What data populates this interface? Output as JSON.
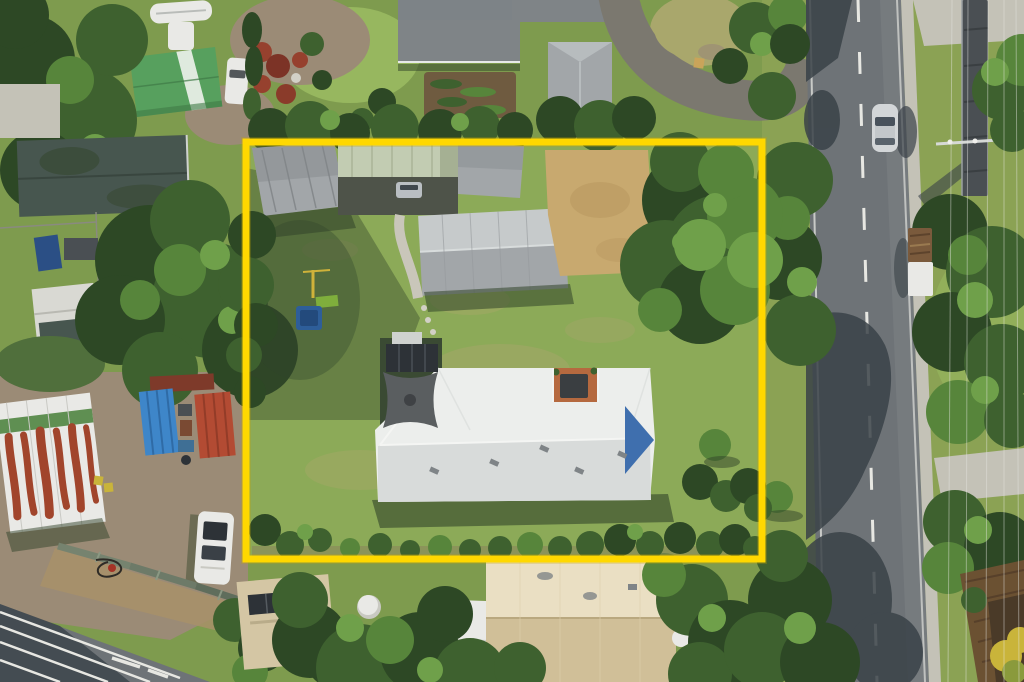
{
  "meta": {
    "type": "aerial-drone-photo",
    "description": "Top-down aerial photograph of a suburban residential lot outlined with a yellow property boundary, bordered by a vertical two-lane road on the right, neighbouring houses, sheds and trees around it.",
    "width_px": 1024,
    "height_px": 682
  },
  "scene": {
    "property_boundary": {
      "shape": "rectangle",
      "color": "#ffd800",
      "x": 246,
      "y": 142,
      "width": 516,
      "height": 417,
      "stroke_px": 7
    },
    "property": {
      "features": [
        "large lawn with dry patches",
        "main house with white hip roof and long ridge",
        "dark shade-sail pergola with solar panel at house rear corner",
        "terracotta courtyard notch with dark furniture",
        "blue tarp triangle on right roof end",
        "gray shed at top-left corner",
        "pale-green roofed carport with parked car",
        "large gray garage roof",
        "sandy dirt driveway area",
        "large tree over right boundary",
        "blue trampoline with green slide and yellow play pole",
        "garden shrubs along bottom boundary"
      ]
    },
    "road": {
      "orientation": "vertical",
      "position": "right",
      "surface": "asphalt",
      "markings": [
        "white dashed centerline",
        "white edge lines"
      ],
      "kerb": "concrete strip",
      "tree_shadows": true
    },
    "vehicles": [
      {
        "type": "car",
        "color": "silver",
        "location": "driving on road",
        "x": 884,
        "y": 128
      },
      {
        "type": "truck",
        "color": "white with brown load",
        "location": "parked on right verge",
        "x": 920,
        "y": 262
      },
      {
        "type": "caravan",
        "color": "white with solar panels",
        "location": "bottom-left yard",
        "x": 214,
        "y": 548
      },
      {
        "type": "car",
        "color": "white",
        "location": "top-left driveway",
        "x": 237,
        "y": 80
      },
      {
        "type": "boat-trailer",
        "color": "white",
        "location": "top-left",
        "x": 180,
        "y": 12
      }
    ],
    "surroundings": [
      "green shed with white stripe (top-left)",
      "dark slate roofed house (left)",
      "round blue kiddie pool and blue tarp (left yard)",
      "workshop shed with rust-streaked white roof and green band (bottom-left)",
      "bright blue shed and red shipping container (bottom-left)",
      "diagonal timber walkway over dirt (bottom-left)",
      "diagonal road with white lane lines (bottom-left corner)",
      "beige house with solar panels (bottom-center)",
      "round white water tank (bottom-center)",
      "white roofed house and large cream roof (bottom-center)",
      "curved asphalt driveway loop around dry grass circle (top-center-right)",
      "gray hip-roof houses and vegetable garden (top-center)",
      "dark elevated linear structure and power pole (top-right)",
      "power lines running along right side",
      "brown timber fenced yard with yellow flowering bush (bottom-right corner)"
    ]
  },
  "colors": {
    "grassBase": "#7e9b4e",
    "lawnInside": "#8caa58",
    "grassVerge": "#8ba254",
    "grassBright": "#97b75f",
    "dryGrass": "#a9a76c",
    "lawnShadow": "#506f3c",
    "treeDark": "#2d4825",
    "treeMid": "#3e612f",
    "treeLight": "#57853b",
    "treeHi": "#6fa04a",
    "shadow": "#32442a",
    "asphalt": "#6e7377",
    "asphaltLight": "#7b8084",
    "roadShadow": "#3a4248",
    "roadLine": "#e7e7e2",
    "concrete": "#c4c2b7",
    "concreteBright": "#d2d0c6",
    "gravel": "#9b8b76",
    "dirt": "#a8906a",
    "sand": "#c8a96f",
    "roofWhite": "#eceeec",
    "roofWhiteShade": "#d8dbda",
    "roofGray": "#a2a6a9",
    "roofGrayDark": "#7f8487",
    "roofSlate": "#47564f",
    "roofPaleGreen": "#c2ccb2",
    "carportDark": "#4e5349",
    "structGray": "#4a4f53",
    "shedGreen": "#57a05e",
    "shedBlue": "#3e86c9",
    "containerRed": "#b34b33",
    "containerDarkRed": "#7e3a2a",
    "rust": "#a1452c",
    "roofBeige": "#d4c6a4",
    "roofCream": "#eadfc3",
    "roofCreamDark": "#d0bf98",
    "terracotta": "#b5693f",
    "panelDark": "#2d3237",
    "sailGray": "#5a5e60",
    "poolBlue": "#3c75b6",
    "tarpBlue": "#2b4f85",
    "trampBlue": "#2e5e99",
    "slideGreen": "#7fae3c",
    "poleYellow": "#cfb23a",
    "white": "#e9e9e6",
    "fenceBrown": "#6b5132",
    "fenceDark": "#4a3a28",
    "bushYellow": "#c9b43a",
    "boundary": "#ffd800"
  }
}
